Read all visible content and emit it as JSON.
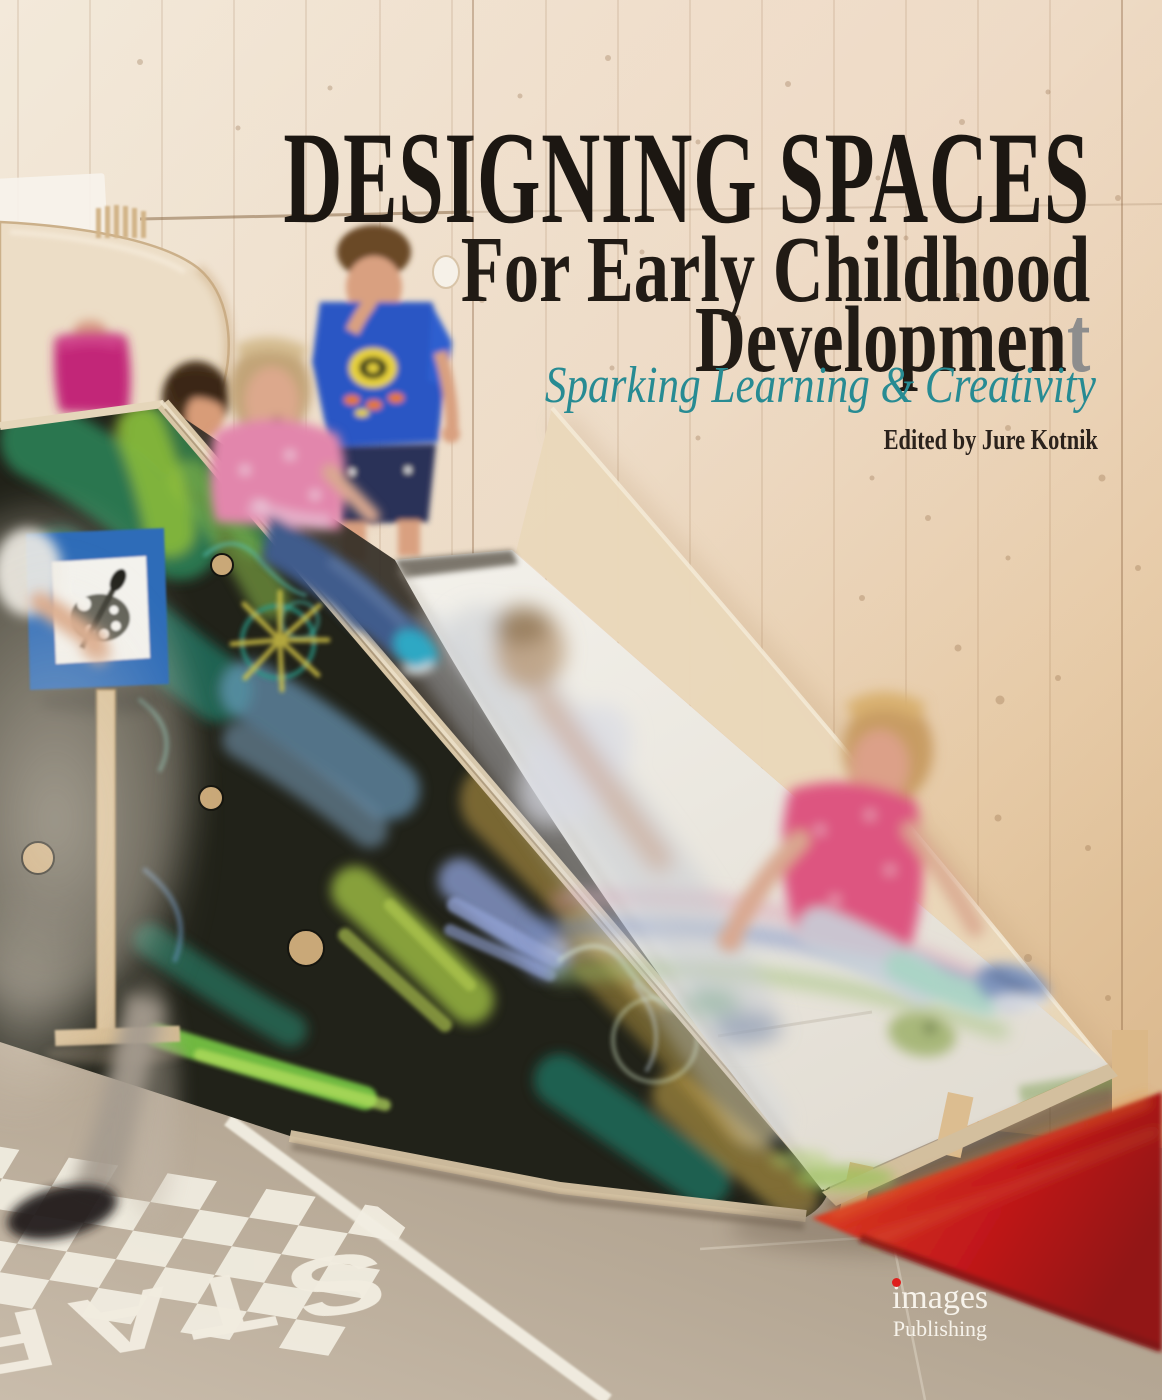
{
  "cover": {
    "title": "DESIGNING SPACES",
    "subtitle_line1": "For Early Childhood",
    "subtitle_line2": "Development",
    "subtitle_line2_main": "Developmen",
    "subtitle_line2_last": "t",
    "tagline": "Sparking Learning & Creativity",
    "credit": "Edited by Jure Kotnik",
    "publisher_name": "images",
    "publisher_division": "Publishing",
    "floor_text": "START",
    "icons": {
      "sign": "palette-icon",
      "publisher_mark": "red-dot-icon"
    },
    "colors": {
      "title_ink": "#1c1712",
      "subtitle_ink": "#211b15",
      "subtitle_last": "#8d8d8d",
      "tagline": "#278b93",
      "credit": "#2b221c",
      "publisher_text": "#f7f3eb",
      "publisher_dot": "#df1f1c",
      "floor_text": "#f1ecdf",
      "sign_blue": "#2e6cb8",
      "chalkboard": "#212219",
      "mat_red": "#c2191a",
      "wall_light": "#f2e7d8",
      "wall_warm": "#ddba8e",
      "floor": "#b5a794",
      "slide_white": "#f0ede7"
    }
  }
}
